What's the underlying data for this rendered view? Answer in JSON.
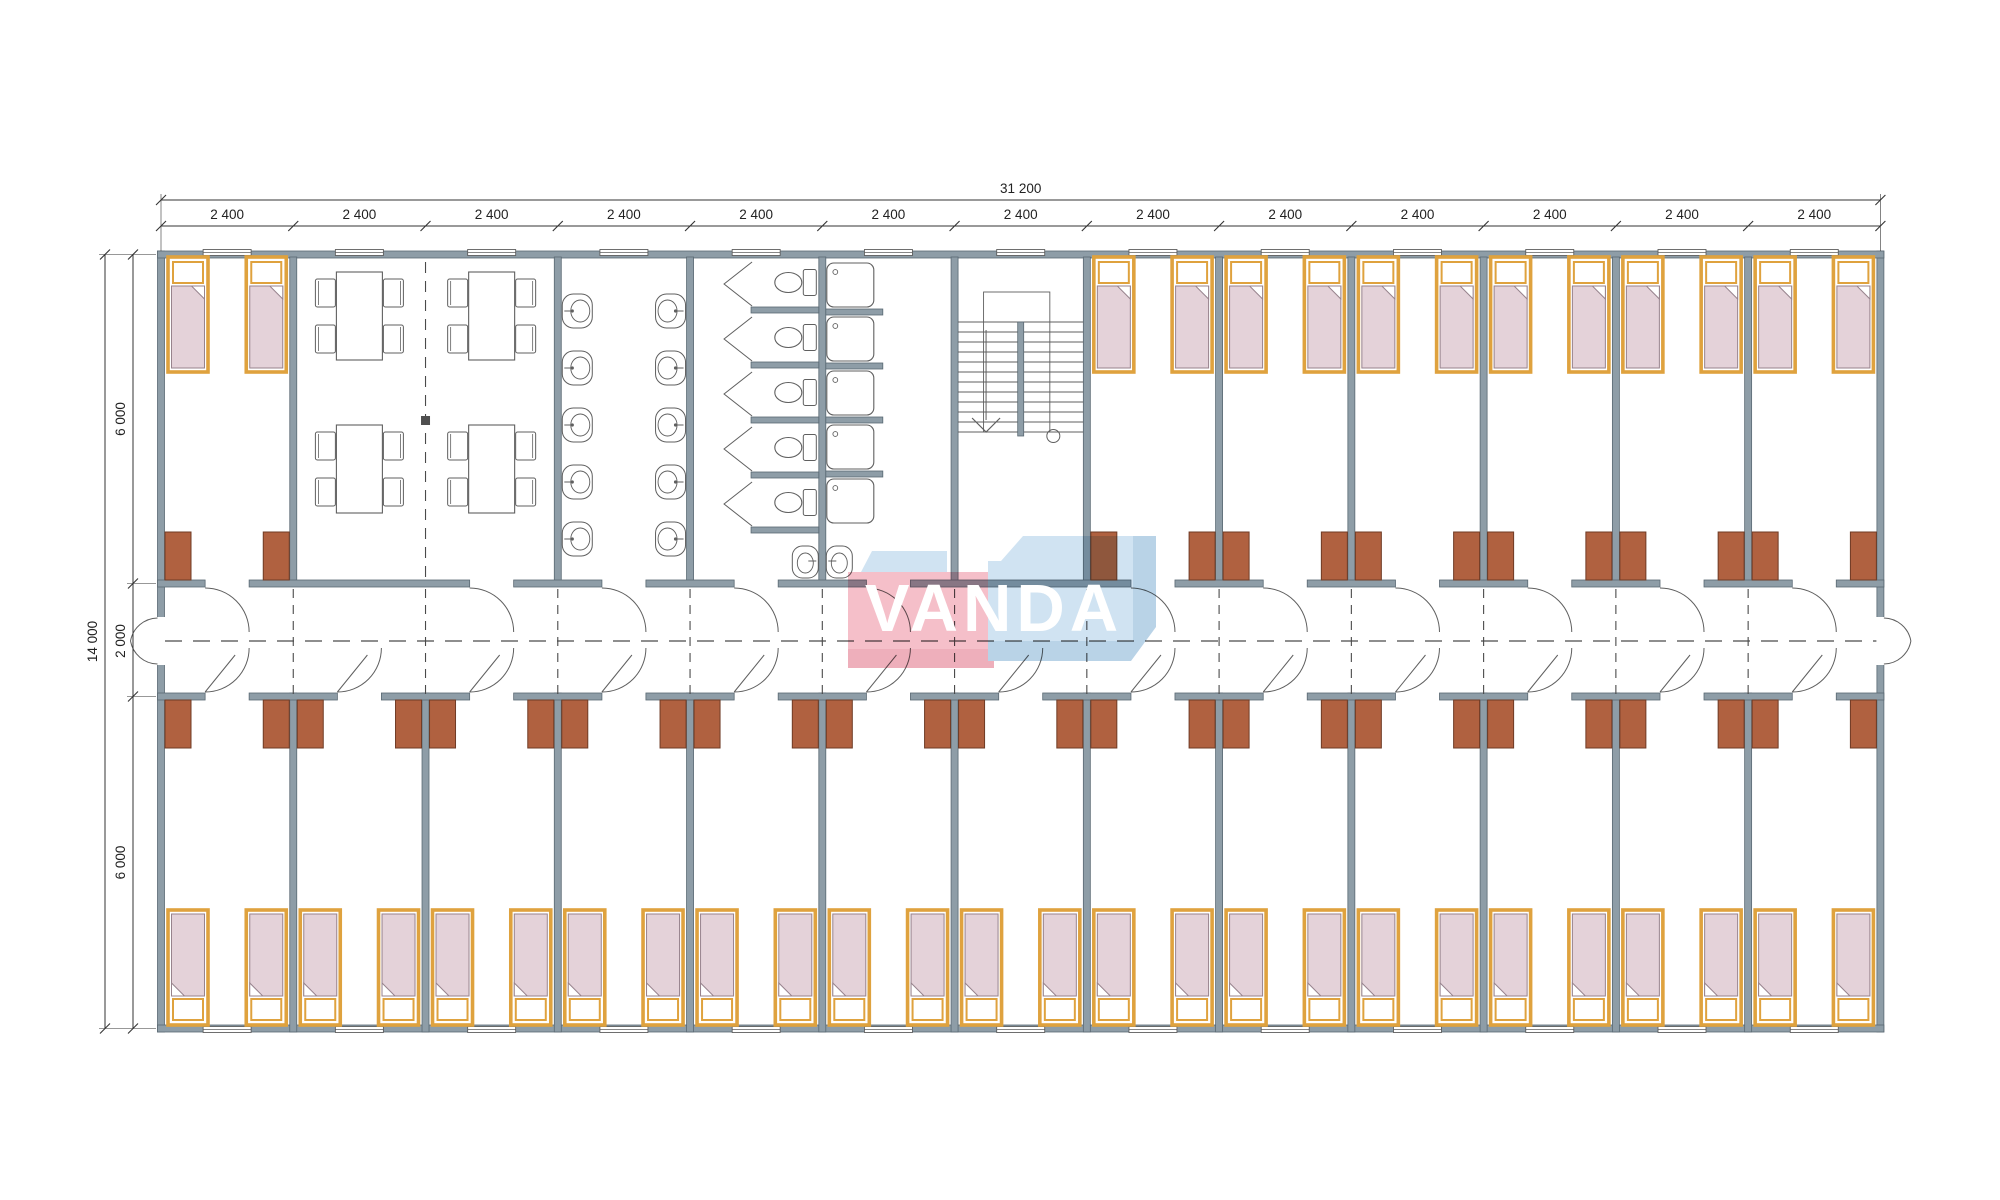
{
  "title": "Modular dormitory floor plan",
  "logo": {
    "text": "VANDA",
    "pink": "#f3b1bd",
    "pink_shade": "#eb9dac",
    "blue": "#c6ddef",
    "blue_shade": "#aac9e2",
    "text_color": "#ffffff"
  },
  "dimensions": {
    "total_width": "31 200",
    "bay": "2 400",
    "bay_count": 13,
    "total_height": "14 000",
    "top_band": "6 000",
    "corridor": "2 000",
    "bottom_band": "6 000"
  },
  "colors": {
    "wall_fill": "#8e9da7",
    "wall_stroke": "#5a6973",
    "fixture_line": "#5f5f5f",
    "dash_line": "#4a4a4a",
    "dim_line": "#333333",
    "dim_text": "#222222",
    "bed_frame": "#dfa23e",
    "mattress_fill": "#e4d2d9",
    "mattress_stroke": "#97838d",
    "pillow_fill": "#ffffff",
    "door_fill": "#b06140",
    "door_stroke": "#6f3b25",
    "window_fill": "#ffffff"
  },
  "layout": {
    "x0": 161,
    "x13": 1880.4,
    "top_wall": 254.5,
    "bottom_wall": 1028.5,
    "corridor_wall_top": 583.5,
    "corridor_wall_bottom": 696.5,
    "dim_line1_y": 200,
    "dim_line2_y": 226,
    "dim_left_outer_x": 105,
    "dim_left_inner_x": 133
  },
  "top_rooms": [
    {
      "type": "bedroom",
      "bays": 1,
      "beds": 2
    },
    {
      "type": "dining",
      "bays": 2,
      "tables": 4,
      "chairs_per_table": 4
    },
    {
      "type": "washroom",
      "bays": 1,
      "sinks": 10
    },
    {
      "type": "toilets",
      "bays": 1,
      "stalls": 5,
      "sinks": 1
    },
    {
      "type": "showers",
      "bays": 1,
      "trays": 5,
      "sinks": 1
    },
    {
      "type": "stairs",
      "bays": 1
    },
    {
      "type": "bedroom",
      "bays": 1,
      "beds": 2
    },
    {
      "type": "bedroom",
      "bays": 1,
      "beds": 2
    },
    {
      "type": "bedroom",
      "bays": 1,
      "beds": 2
    },
    {
      "type": "bedroom",
      "bays": 1,
      "beds": 2
    },
    {
      "type": "bedroom",
      "bays": 1,
      "beds": 2
    },
    {
      "type": "bedroom",
      "bays": 1,
      "beds": 2
    }
  ],
  "bottom_band": {
    "room_type": "bedroom",
    "count": 13,
    "beds_per_room": 2,
    "doors_per_room": 2
  }
}
